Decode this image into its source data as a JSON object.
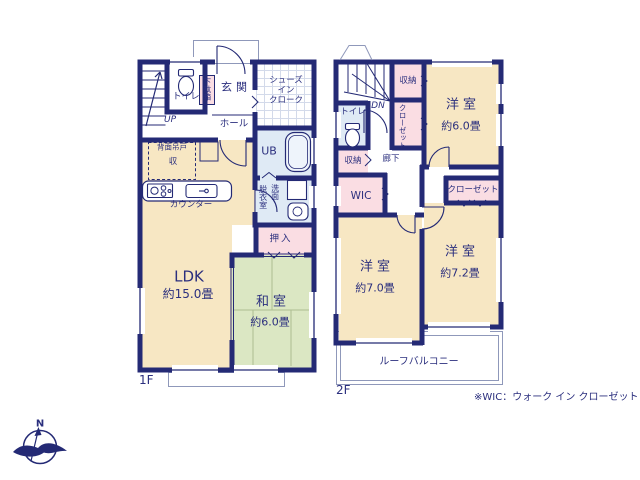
{
  "colors": {
    "wall": "#242a75",
    "text": "#2b2f7e",
    "room_cream": "#f7e7c3",
    "room_green": "#dbe7c3",
    "room_pink": "#fadde3",
    "room_blue": "#dfeaf5"
  },
  "floor1": {
    "floor_label": "1F",
    "stairs": "UP",
    "toilet": "トイレ",
    "shoe_box": "下駄箱",
    "entrance": "玄関",
    "shoes_closet_lines": [
      "シューズ",
      "イン",
      "クローク"
    ],
    "hall": "ホール",
    "rear_cupboard": "背面吊戸",
    "storage": "収",
    "counter": "カウンター",
    "unit_bath": "UB",
    "dressing_room": "脱衣室",
    "washroom": "洗面",
    "closet": "押入",
    "ldk_name": "LDK",
    "ldk_size": "約15.0畳",
    "japanese_room_name": "和室",
    "japanese_room_size": "約6.0畳"
  },
  "floor2": {
    "floor_label": "2F",
    "stairs": "DN",
    "storage_top": "収納",
    "closet_vertical": "クローゼット",
    "toilet": "トイレ",
    "storage_left": "収納",
    "corridor": "廊下",
    "wic": "WIC",
    "bedroom_a_name": "洋室",
    "bedroom_a_size": "約6.0畳",
    "bedroom_b_name": "洋室",
    "bedroom_b_size": "約7.0畳",
    "bedroom_c_name": "洋室",
    "bedroom_c_size": "約7.2畳",
    "closet_right": "クローゼット",
    "roof_balcony": "ルーフバルコニー"
  },
  "footnote": "※WIC：ウォーク イン クローゼット",
  "compass": {
    "north": "N"
  }
}
